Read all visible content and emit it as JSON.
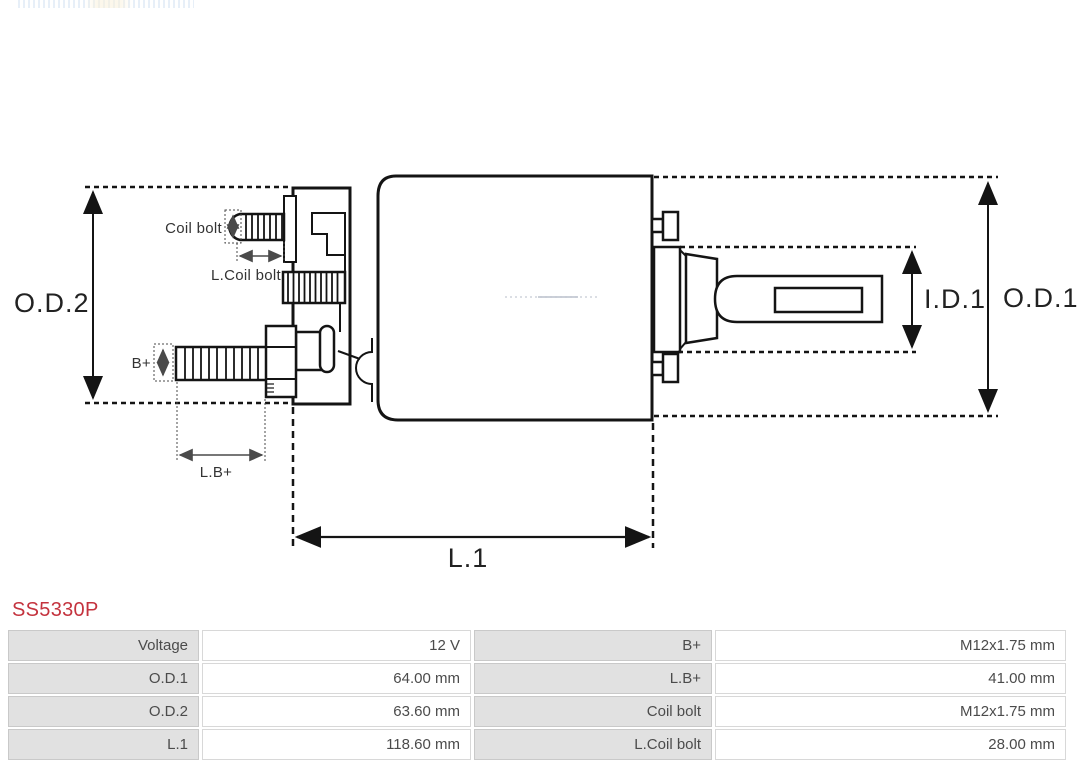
{
  "brand": {
    "part_number": "SS5330P",
    "part_number_color": "#c4333e"
  },
  "diagram": {
    "line_color": "#141414",
    "labels": {
      "od2": "O.D.2",
      "od1": "O.D.1",
      "id1": "I.D.1",
      "l1": "L.1",
      "coil_bolt": "Coil bolt",
      "l_coil_bolt": "L.Coil bolt",
      "b_plus": "B+",
      "l_b_plus": "L.B+"
    }
  },
  "table": {
    "label_bg": "#e1e1e1",
    "value_bg": "#ffffff",
    "rows": [
      {
        "label1": "Voltage",
        "value1": "12 V",
        "label2": "B+",
        "value2": "M12x1.75 mm"
      },
      {
        "label1": "O.D.1",
        "value1": "64.00 mm",
        "label2": "L.B+",
        "value2": "41.00 mm"
      },
      {
        "label1": "O.D.2",
        "value1": "63.60 mm",
        "label2": "Coil bolt",
        "value2": "M12x1.75 mm"
      },
      {
        "label1": "L.1",
        "value1": "118.60 mm",
        "label2": "L.Coil bolt",
        "value2": "28.00 mm"
      }
    ]
  }
}
